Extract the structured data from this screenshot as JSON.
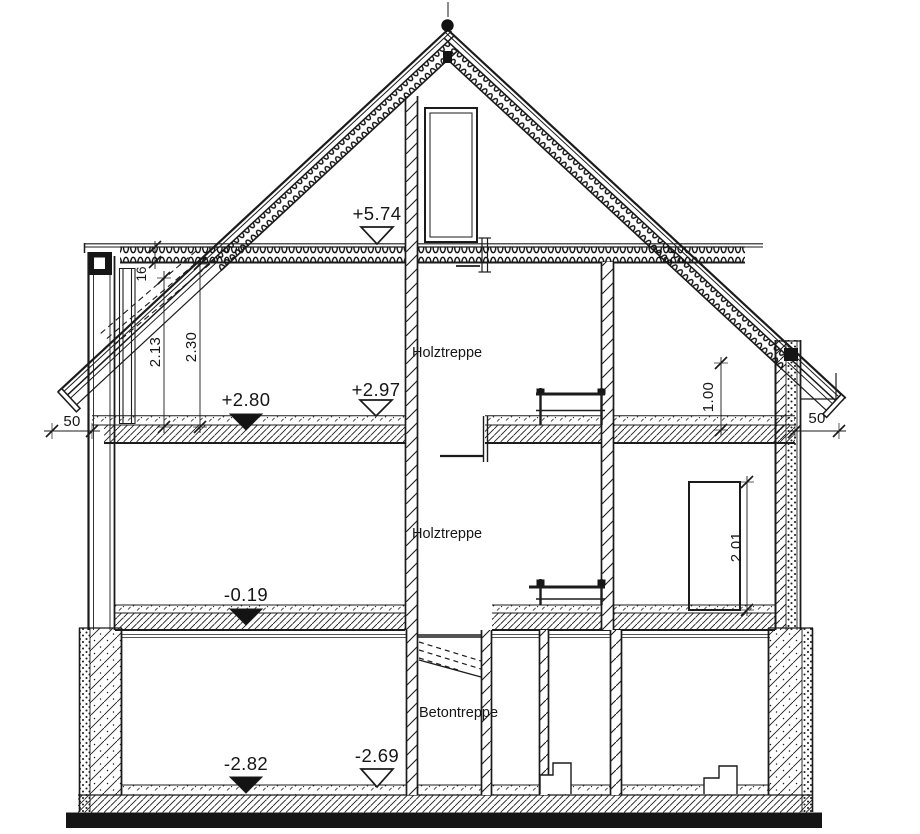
{
  "page": {
    "background": "#ffffff",
    "ink": "#1b1b1b"
  },
  "section_drawing": {
    "type": "building-cross-section",
    "room_labels": {
      "attic_stair": "Holztreppe",
      "ground_stair": "Holztreppe",
      "basement_stair": "Betontreppe"
    },
    "elevation_markers": {
      "collar_ceiling": {
        "value": "+5.74",
        "symbol": "open-triangle"
      },
      "attic_finish_floor": {
        "value": "+2.97",
        "symbol": "open-triangle"
      },
      "attic_raw_floor": {
        "value": "+2.80",
        "symbol": "filled-triangle"
      },
      "ground_raw_floor": {
        "value": "-0.19",
        "symbol": "filled-triangle"
      },
      "basement_finish_floor": {
        "value": "-2.69",
        "symbol": "open-triangle"
      },
      "basement_raw_floor": {
        "value": "-2.82",
        "symbol": "filled-triangle"
      }
    },
    "dimensions": {
      "attic_clear_height_a": "2.13",
      "attic_clear_height_b": "2.30",
      "collar_beam_depth": "16",
      "knee_wall_height": "1.00",
      "door_height": "2.01",
      "eaves_overhang_left": "50",
      "eaves_overhang_right": "50"
    }
  }
}
